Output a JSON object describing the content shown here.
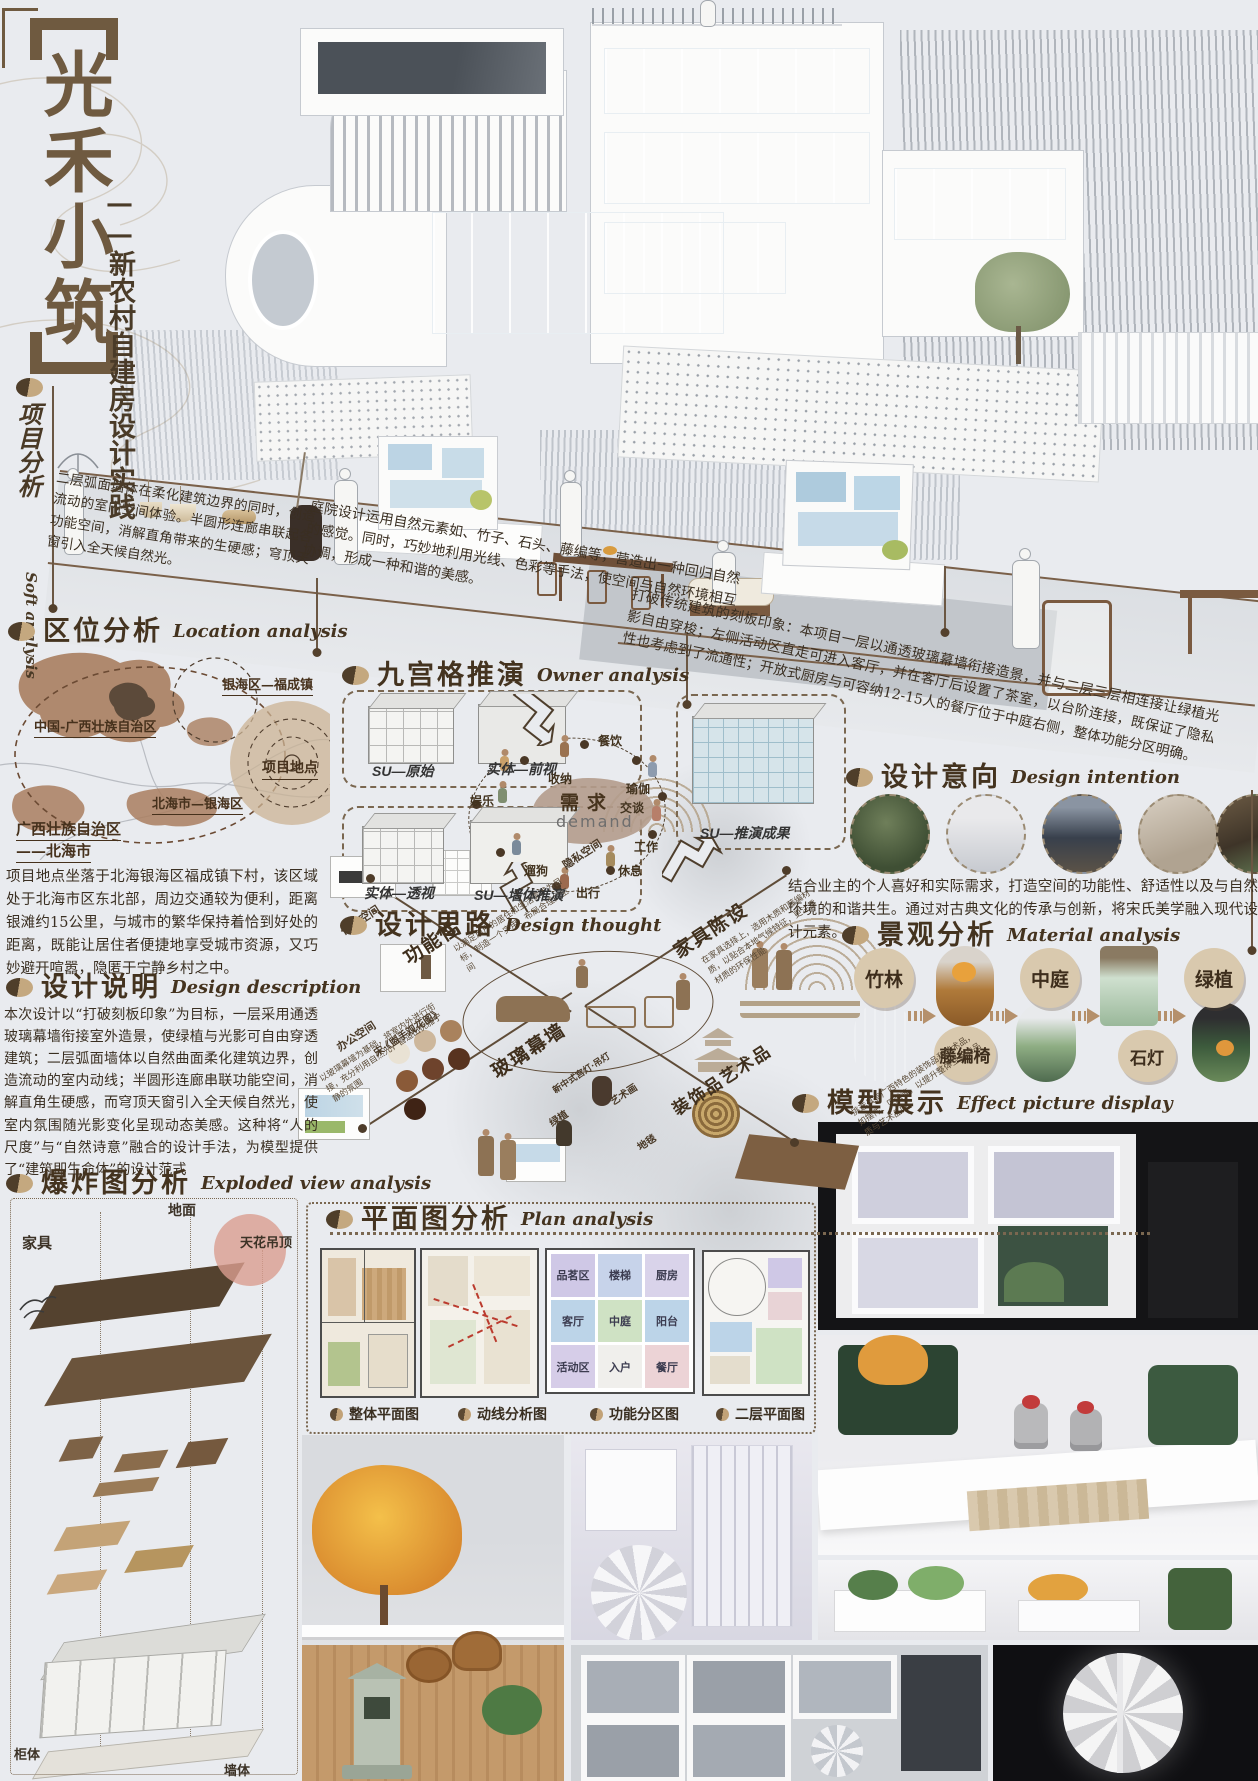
{
  "header": {
    "title": "光禾小筑",
    "subtitle": "——新农村自建房设计实践",
    "side_cn": "项目分析",
    "side_en": "Soft analysis",
    "intro_note": "二层弧面墙体在柔化建筑边界的同时，创造流动的室内空间体验。半圆形连廊串联起各功能空间，消解直角带来的生硬感；穹顶天窗引入全天候自然光。"
  },
  "location": {
    "heading_cn": "区位分析",
    "heading_en": "Location analysis",
    "labels": {
      "china": "中国-广西壮族自治区",
      "town": "银海区—福成镇",
      "site": "项目地点",
      "district": "北海市—银海区",
      "prov1": "广西壮族自治区",
      "prov2": "——北海市"
    },
    "body": "项目地点坐落于北海银海区福成镇下村，该区域处于北海市区东北部，周边交通较为便利，距离银滩约15公里，与城市的繁华保持着恰到好处的距离，既能让居住者便捷地享受城市资源，又巧妙避开喧嚣，隐匿于宁静乡村之中。"
  },
  "desc": {
    "heading_cn": "设计说明",
    "heading_en": "Design description",
    "body": "本次设计以“打破刻板印象”为目标，一层采用通透玻璃幕墙衔接室外造景，使绿植与光影可自由穿透建筑；二层弧面墙体以自然曲面柔化建筑边界，创造流动的室内动线；半圆形连廊串联功能空间，消解直角生硬感，而穹顶天窗引入全天候自然光，使室内氛围随光影变化呈现动态美感。这种将“人的尺度”与“自然诗意”融合的设计手法，为模型提供了“建筑即生命体”的设计范式"
  },
  "exploded": {
    "heading_cn": "爆炸图分析",
    "heading_en": "Exploded view analysis",
    "labels": [
      "地面",
      "家具",
      "天花吊顶",
      "柜体",
      "墙体"
    ]
  },
  "notes": {
    "courtyard": "庭院设计运用自然元素如、竹子、石头、藤编等，营造出一种回归自然的感觉。同时，巧妙地利用光线、色彩等手法，使空间与自然环境相互协调，形成一种和谐的美感。",
    "concept": "打破传统建筑的刻板印象：本项目一层以通透玻璃幕墙衔接造景，并与二层三层相连接让绿植光影自由穿梭；左侧活动区直走可进入客厅，并在客厅后设置了茶室，以台阶连接，既保证了隐私性也考虑到了流通性；开放式厨房与可容纳12-15人的餐厅位于中庭右侧，整体功能分区明确。"
  },
  "grid": {
    "heading_cn": "九宫格推演",
    "heading_en": "Owner analysis",
    "captions": [
      "SU—原始",
      "实体—前视",
      "实体—透视",
      "SU—墙体推演",
      "SU—推演成果"
    ],
    "demand_cn": "需求",
    "demand_en": "demand",
    "activities": [
      "餐饮",
      "收纳",
      "瑜伽",
      "交谈",
      "娱乐",
      "工作",
      "休息",
      "出行",
      "遛狗"
    ]
  },
  "intent": {
    "heading_cn": "设计意向",
    "heading_en": "Design intention",
    "body": "结合业主的个人喜好和实际需求，打造空间的功能性、舒适性以及与自然环境的和谐共生。通过对古典文化的传承与创新，将宋氏美学融入现代设计元素。"
  },
  "material": {
    "heading_cn": "景观分析",
    "heading_en": "Material analysis",
    "chain": [
      "竹林",
      "藤编椅",
      "中庭",
      "石灯",
      "绿植"
    ]
  },
  "thought": {
    "heading_cn": "设计思路",
    "heading_en": "Design thought",
    "nodes": [
      "休息空间",
      "功能性",
      "办公空间",
      "隐私空间",
      "家具陈设",
      "玻璃幕墙",
      "装饰品艺术品",
      "新中式宫灯·吊灯",
      "绿植",
      "艺术画",
      "地毯"
    ],
    "palette_ref": "宋·《盥手观花图》",
    "annos": [
      "以满足用户的居住和生活需求为目标，制造一个实用、布局合理的空间",
      "以玻璃幕墙为基础，将室内外进行衔接，充分利用自然光，营造出优雅宁静的氛围",
      "在家具选择上，选用木质和藤编材质，以贴合本地气候特征，更注重材质的环保性能",
      "挑选具有广西特色的装饰品和艺术品，如摆件、贝雕等，以提升整体空间的品质与艺术品味。"
    ]
  },
  "plan": {
    "heading_cn": "平面图分析",
    "heading_en": "Plan analysis",
    "legend": [
      "整体平面图",
      "动线分析图",
      "功能分区图",
      "二层平面图"
    ],
    "rooms": [
      "品茗区",
      "楼梯",
      "厨房",
      "客厅",
      "中庭",
      "阳台",
      "活动区",
      "入户",
      "餐厅"
    ]
  },
  "model": {
    "heading_cn": "模型展示",
    "heading_en": "Effect picture display"
  }
}
